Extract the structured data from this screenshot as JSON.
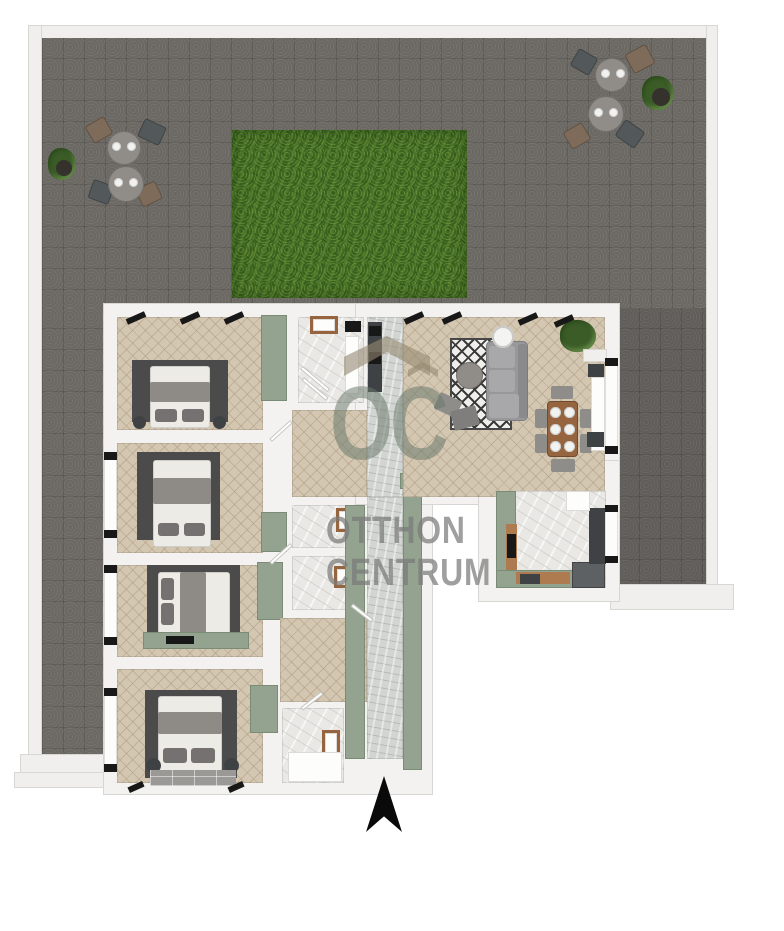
{
  "watermark": {
    "logo_text": "OC",
    "line1": "OTTHON",
    "line2": "CENTRUM"
  },
  "scene": {
    "type": "3d-floor-plan-render",
    "areas": [
      "terrace",
      "grass-patch",
      "bedroom-1",
      "bedroom-2",
      "bedroom-3",
      "bedroom-4",
      "bathroom-1",
      "bathroom-2",
      "wc",
      "bathroom-3",
      "hallway",
      "entry-corridor",
      "living-room",
      "dining-area",
      "kitchen"
    ],
    "terrace_furniture": [
      "patio-table",
      "patio-chairs",
      "potted-plants"
    ],
    "compass": "north-arrow-pointing-up"
  },
  "colors": {
    "page-bg": "#ffffff",
    "paving": "#7d7a75",
    "paving-line": "rgba(50,48,45,0.22)",
    "terrace-wall": "#f0efed",
    "terrace-wall-border": "#d9d7d4",
    "grass": "#527c2e",
    "grass-dark": "#3c6220",
    "grass-light": "#6f9a3e",
    "wall": "#f3f2f0",
    "wall-border": "#d8d6d3",
    "parquet": "#d4c7b2",
    "parquet-line": "rgba(166,148,120,0.45)",
    "marble": "#e9e8e4",
    "marble-vein": "rgba(190,190,186,0.5)",
    "corridor-marble": "#d2d5d1",
    "sage": "#93a38f",
    "sage-dark": "#7a8c76",
    "wood": "#96653f",
    "wood-light": "#ad7b4f",
    "dark-rug": "#4b4b4b",
    "bed-white": "#edebe6",
    "blanket": "#8e8a86",
    "pillow": "#757170",
    "sofa": "#98979a",
    "sofa-light": "#a8a7aa",
    "gray-furniture": "#8e8d8a",
    "dark-furniture": "#3f4244",
    "black": "#181818",
    "fridge": "#5d6163",
    "plant": "#3b5c27",
    "plant-dark": "#2c4a1d",
    "chair-brown": "#7e6b59",
    "chair-dark": "#53585a",
    "table-top": "#908d88",
    "plate": "#f2f2f0",
    "tile-rug": "#9a9996",
    "wm-roof": "rgba(148,136,113,0.6)",
    "wm-logo": "rgba(104,119,105,0.52)",
    "wm-text": "rgba(122,122,122,0.72)",
    "arrow": "#0a0a0a"
  }
}
